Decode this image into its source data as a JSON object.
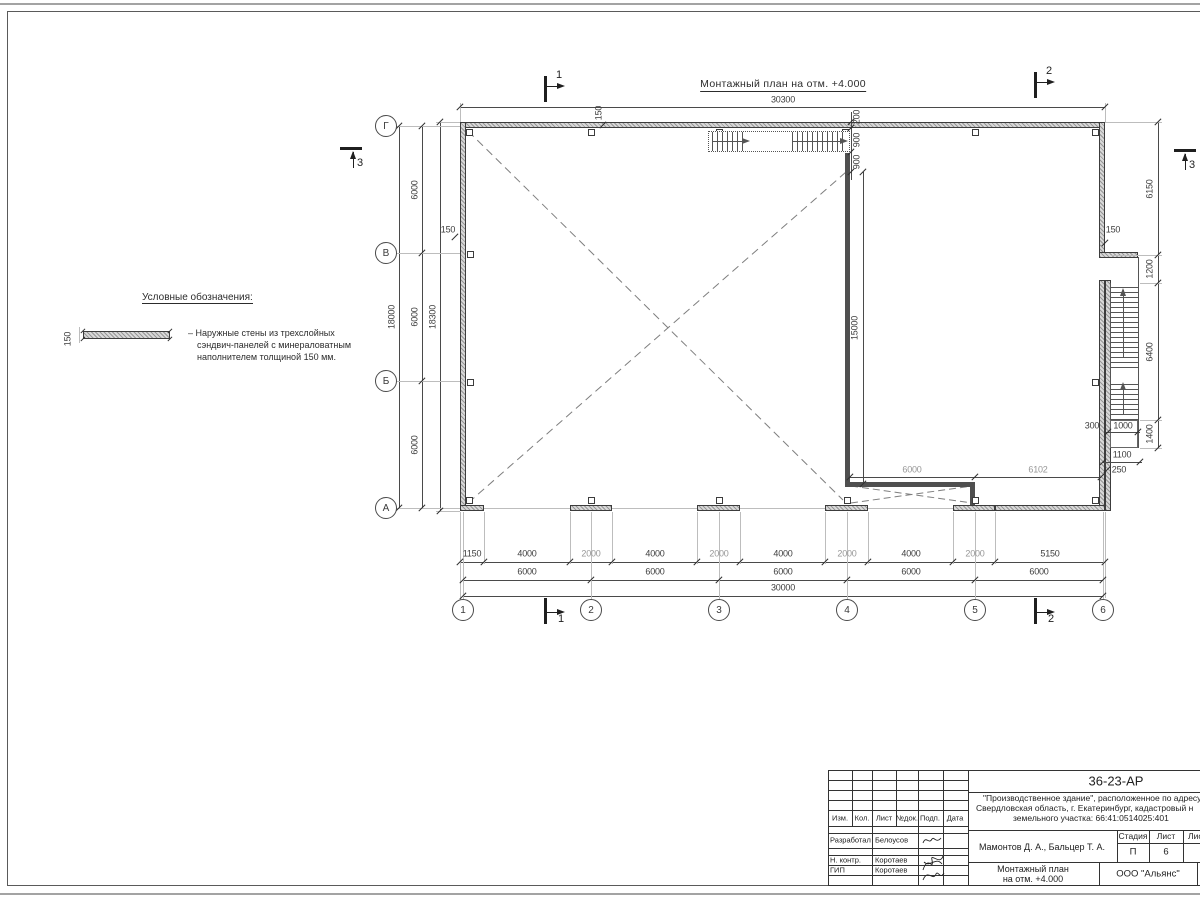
{
  "sheet": {
    "plan_title": "Монтажный план на отм. +4.000",
    "legend": {
      "heading": "Условные обозначения:",
      "sample_dim": "150",
      "item_line1": "– Наружные стены из трехслойных",
      "item_line2": "сэндвич-панелей с минераловатным",
      "item_line3": "наполнителем толщиной 150 мм."
    }
  },
  "axes": {
    "letters": [
      "Г",
      "В",
      "Б",
      "А"
    ],
    "numbers": [
      "1",
      "2",
      "3",
      "4",
      "5",
      "6"
    ]
  },
  "sections": {
    "one": "1",
    "two": "2",
    "three": "3"
  },
  "dims": {
    "top_overall": "30300",
    "b1": [
      "1150",
      "4000",
      "2000",
      "4000",
      "2000",
      "4000",
      "2000",
      "4000",
      "2000",
      "5150"
    ],
    "b2": [
      "6000",
      "6000",
      "6000",
      "6000",
      "6000"
    ],
    "b3": "30000",
    "l_seg": [
      "6000",
      "6000",
      "6000"
    ],
    "l_tot": "18000",
    "l_out": "18300",
    "r_seg": [
      "6150",
      "1200",
      "6400",
      "1400"
    ],
    "off150": "150",
    "off200": "200",
    "stair900": "900",
    "w15000": "15000",
    "w6000": "6000",
    "w6102": "6102",
    "rb300": "300",
    "rb1000": "1000",
    "rb1100": "1100",
    "rb250": "250"
  },
  "title_block": {
    "code": "36-23-АР",
    "address_line1": "\"Производственное здание\", расположенное по адресу:",
    "address_line2": "Свердловская область, г. Екатеринбург, кадастровый н",
    "address_line3": "земельного участка: 66:41:0514025:401",
    "authors": "Мамонтов Д. А., Бальцер Т. А.",
    "stage_header1": "Стадия",
    "stage_header2": "Лист",
    "stage_header3": "Лис",
    "stage_value": "П",
    "sheet_value": "6",
    "doc_title_line1": "Монтажный план",
    "doc_title_line2": "на отм. +4.000",
    "company": "ООО \"Альянс\"",
    "col_h1": "Изм.",
    "col_h2": "Кол.",
    "col_h3": "Лист",
    "col_h4": "№док.",
    "col_h5": "Подп.",
    "col_h6": "Дата",
    "role1": "Разработал",
    "name1": "Белоусов",
    "role2": "Н. контр.",
    "name2": "Коротаев",
    "role3": "ГИП",
    "name3": "Коротаев"
  }
}
